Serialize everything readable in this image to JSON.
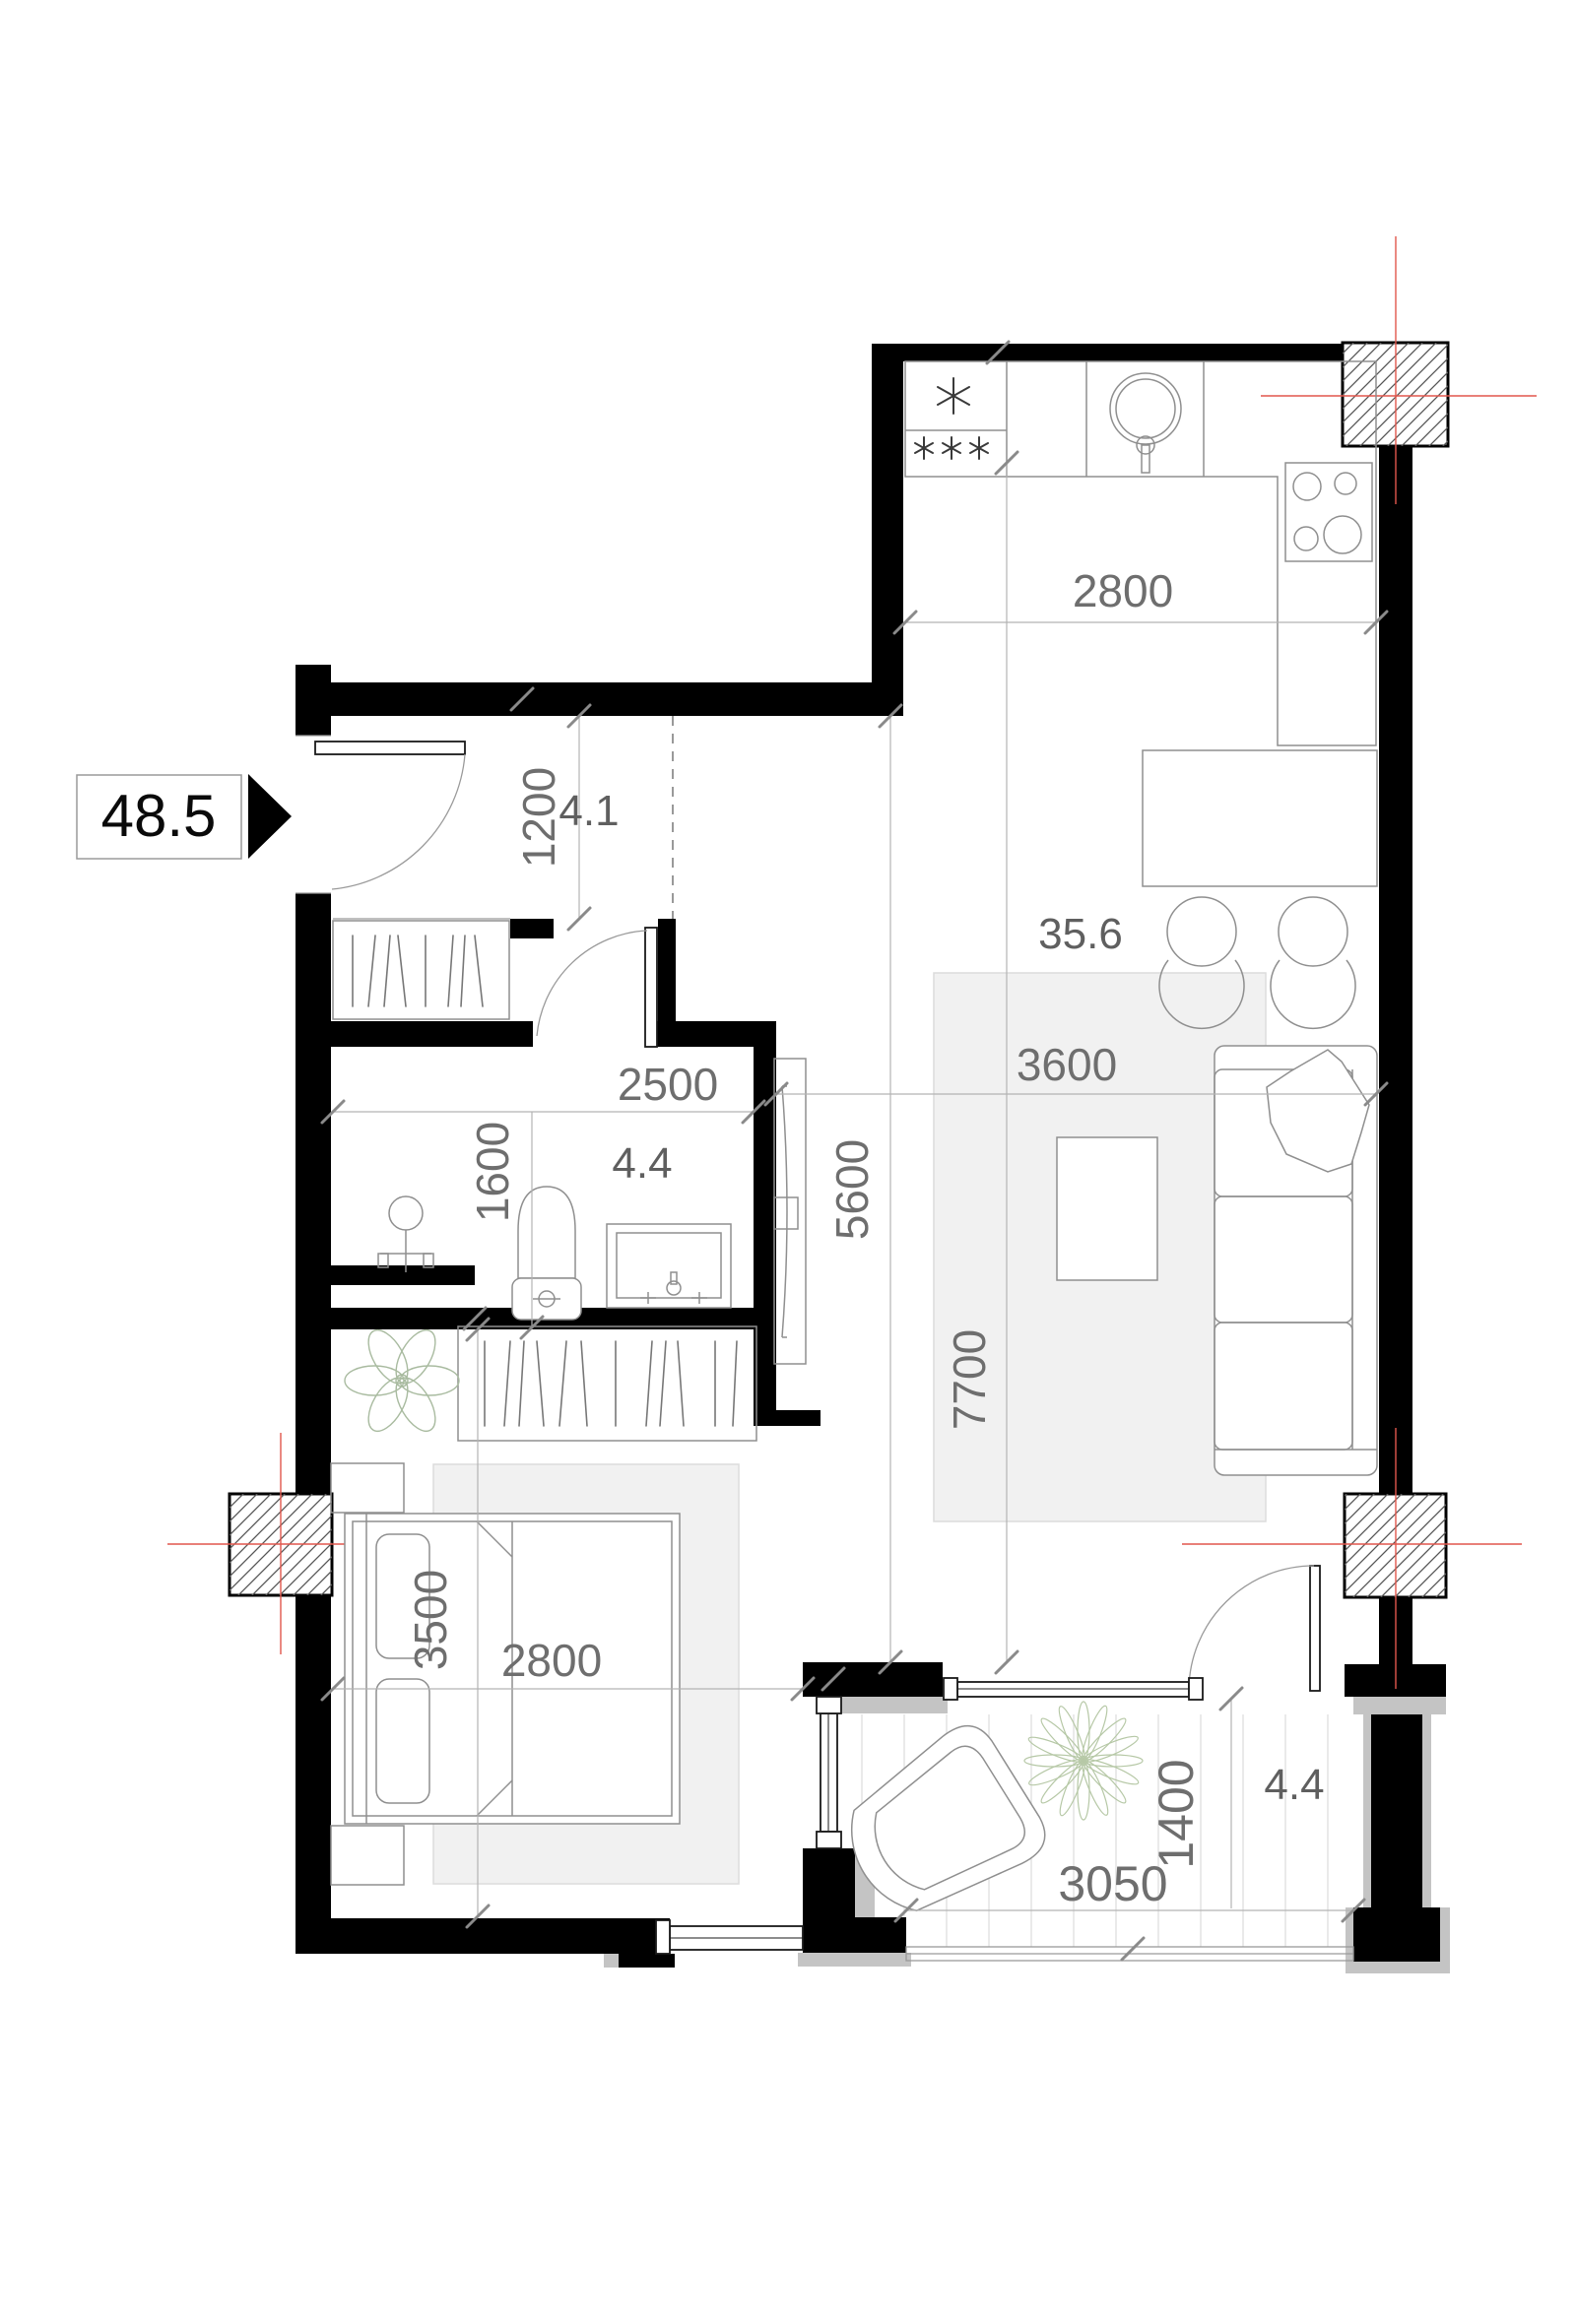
{
  "plan": {
    "title_area_badge": "48.5",
    "colors": {
      "wall": "#000000",
      "dimension_text": "#6e6e6e",
      "axis_red": "#e2574d",
      "rug": "#f1f1f1",
      "plant_green": "#a9bba0"
    },
    "rooms": {
      "hallway": {
        "area": "4.1"
      },
      "living_kitchen": {
        "area": "35.6"
      },
      "bathroom": {
        "area": "4.4"
      },
      "balcony": {
        "area": "4.4"
      }
    },
    "dimensions": {
      "kitchen_width": "2800",
      "hallway_depth": "1200",
      "bathroom_width": "2500",
      "bathroom_depth": "1600",
      "living_length": "5600",
      "living_width": "3600",
      "total_length": "7700",
      "bedroom_length": "3500",
      "bedroom_width": "2800",
      "balcony_width": "3050",
      "balcony_depth": "1400"
    }
  }
}
